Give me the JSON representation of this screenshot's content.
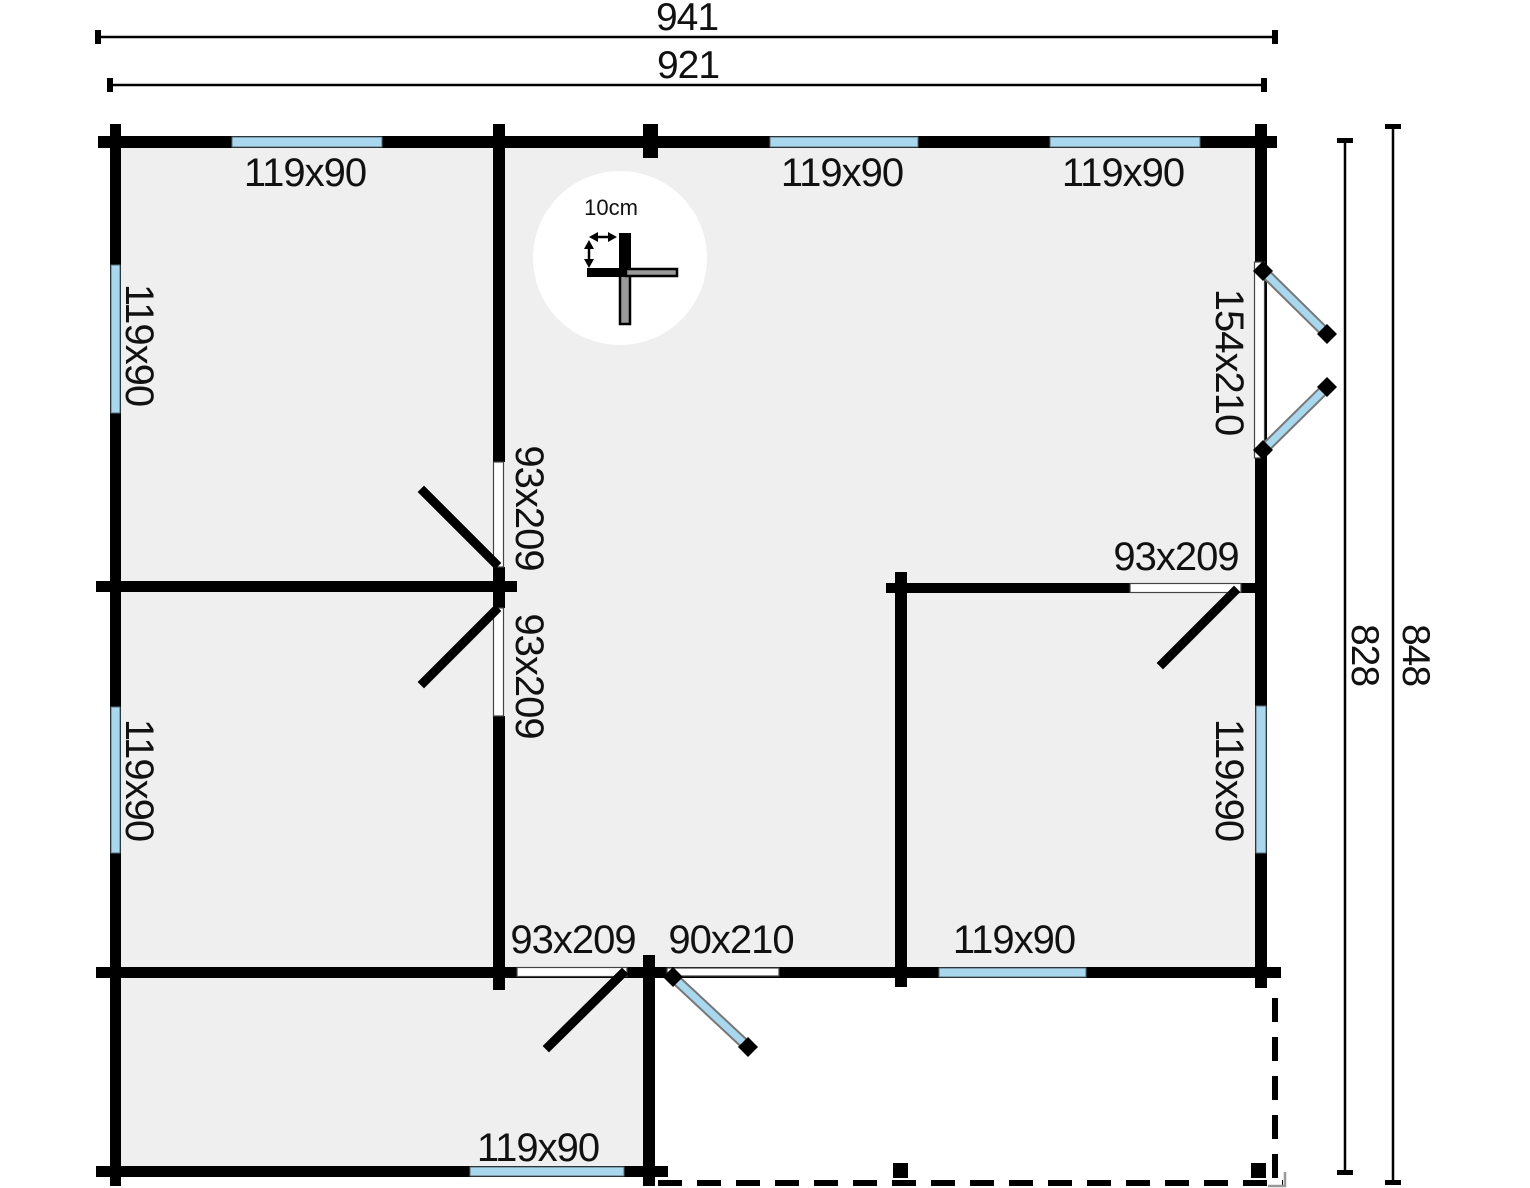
{
  "title": "log-cabin-floor-plan",
  "dimensions": {
    "width_total": "941",
    "width_inner": "921",
    "height_total": "848",
    "height_inner": "828"
  },
  "scale": {
    "label": "10cm"
  },
  "windows": {
    "top_left": "119x90",
    "top_middle": "119x90",
    "top_right": "119x90",
    "left_upper": "119x90",
    "left_lower": "119x90",
    "right_lower": "119x90",
    "bottom_inner": "119x90",
    "annex_bottom": "119x90"
  },
  "doors": {
    "right_double": "154x210",
    "hall_upper": "93x209",
    "hall_lower": "93x209",
    "annex": "93x209",
    "room_right": "93x209",
    "entry": "90x210"
  },
  "colors": {
    "wall": "#000000",
    "window_glass": "#a8d7ee",
    "floor": "#efefef",
    "background": "#ffffff",
    "line": "#000000"
  }
}
